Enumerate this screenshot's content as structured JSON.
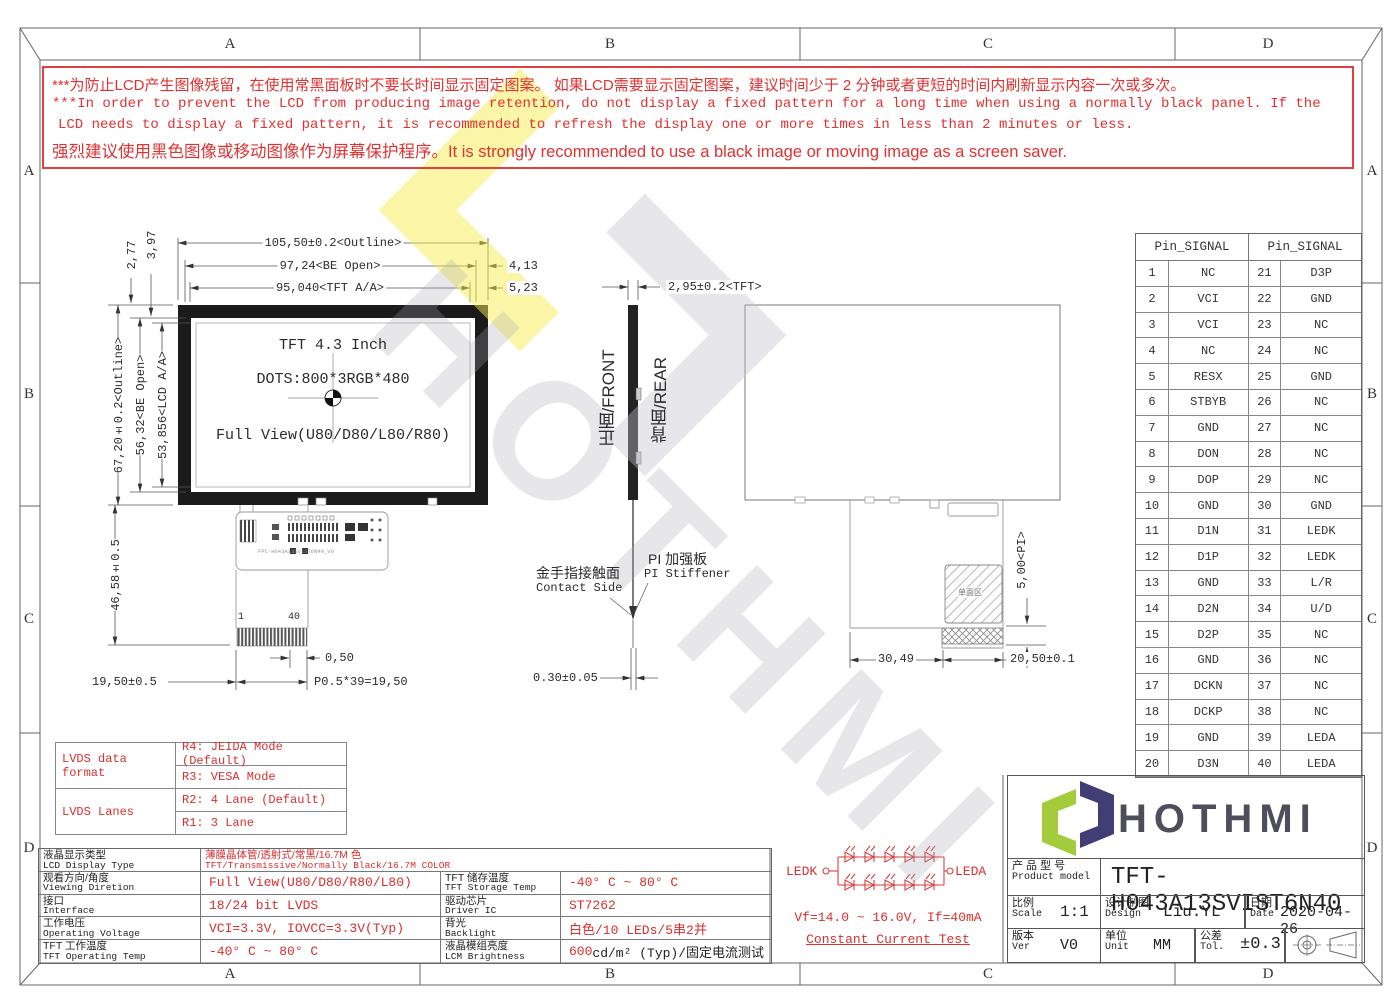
{
  "frame": {
    "zones": [
      "A",
      "B",
      "C",
      "D"
    ]
  },
  "warning": {
    "line1_cn": "***为防止LCD产生图像残留，在使用常黑面板时不要长时间显示固定图案。 如果LCD需要显示固定图案，建议时间少于 2 分钟或者更短的时间内刷新显示内容一次或多次。",
    "line2_en": "***In order to prevent the LCD from producing image retention, do not display a fixed pattern for a long time when using a normally black panel. If the",
    "line3_en": "LCD needs to display a fixed pattern, it is recommended to refresh the display one or more times in less than 2 minutes or less.",
    "line4_mixed": "强烈建议使用黑色图像或移动图像作为屏幕保护程序。It is strongly recommended to use a black image or moving image as a screen saver."
  },
  "watermark": {
    "text": "HOTHMI"
  },
  "front_view": {
    "title": "TFT 4.3 Inch",
    "dots": "DOTS:800*3RGB*480",
    "view": "Full View(U80/D80/L80/R80)",
    "fpc_label": "FPC-H043A13SVIST6N40_V0",
    "pin_start": "1",
    "pin_end": "40"
  },
  "side_view": {
    "front_label": "正面/FRONT",
    "rear_label": "背面/REAR",
    "contact_cn": "金手指接触面",
    "contact_en": "Contact Side",
    "stiffener_cn": "PI 加强板",
    "stiffener_en": "PI Stiffener"
  },
  "rear_view": {
    "hatch_label": "单面区"
  },
  "dims": {
    "outline_w": "105,50±0.2<Outline>",
    "be_open_w": "97,24<BE Open>",
    "tft_aa_w": "95,040<TFT A/A>",
    "gap_right_1": "4,13",
    "gap_right_2": "5,23",
    "gap_top_1": "2,77",
    "gap_top_2": "3,97",
    "outline_h": "67,20±0.2<Outline>",
    "be_open_h": "56,32<BE Open>",
    "lcd_aa_h": "53,856<LCD A/A>",
    "fpc_len": "46,58±0.5",
    "tail_w": "19,50±0.5",
    "pitch_one": "0,50",
    "pitch_total": "P0.5*39=19,50",
    "thickness": "2,95±0.2<TFT>",
    "fpc_thick": "0.30±0.05",
    "pi_len": "5,00<PI>",
    "tail_x": "30,49",
    "tail_w2": "20,50±0.1"
  },
  "pin_table": {
    "header1": "Pin_SIGNAL",
    "header2": "Pin_SIGNAL",
    "rows": [
      {
        "p1": "1",
        "s1": "NC",
        "p2": "21",
        "s2": "D3P"
      },
      {
        "p1": "2",
        "s1": "VCI",
        "p2": "22",
        "s2": "GND"
      },
      {
        "p1": "3",
        "s1": "VCI",
        "p2": "23",
        "s2": "NC"
      },
      {
        "p1": "4",
        "s1": "NC",
        "p2": "24",
        "s2": "NC"
      },
      {
        "p1": "5",
        "s1": "RESX",
        "p2": "25",
        "s2": "GND"
      },
      {
        "p1": "6",
        "s1": "STBYB",
        "p2": "26",
        "s2": "NC"
      },
      {
        "p1": "7",
        "s1": "GND",
        "p2": "27",
        "s2": "NC"
      },
      {
        "p1": "8",
        "s1": "DON",
        "p2": "28",
        "s2": "NC"
      },
      {
        "p1": "9",
        "s1": "DOP",
        "p2": "29",
        "s2": "NC"
      },
      {
        "p1": "10",
        "s1": "GND",
        "p2": "30",
        "s2": "GND"
      },
      {
        "p1": "11",
        "s1": "D1N",
        "p2": "31",
        "s2": "LEDK"
      },
      {
        "p1": "12",
        "s1": "D1P",
        "p2": "32",
        "s2": "LEDK"
      },
      {
        "p1": "13",
        "s1": "GND",
        "p2": "33",
        "s2": "L/R"
      },
      {
        "p1": "14",
        "s1": "D2N",
        "p2": "34",
        "s2": "U/D"
      },
      {
        "p1": "15",
        "s1": "D2P",
        "p2": "35",
        "s2": "NC"
      },
      {
        "p1": "16",
        "s1": "GND",
        "p2": "36",
        "s2": "NC"
      },
      {
        "p1": "17",
        "s1": "DCKN",
        "p2": "37",
        "s2": "NC"
      },
      {
        "p1": "18",
        "s1": "DCKP",
        "p2": "38",
        "s2": "NC"
      },
      {
        "p1": "19",
        "s1": "GND",
        "p2": "39",
        "s2": "LEDA"
      },
      {
        "p1": "20",
        "s1": "D3N",
        "p2": "40",
        "s2": "LEDA"
      }
    ]
  },
  "lvds_table": {
    "group1": "LVDS data format",
    "g1r1": "R4: JEIDA Mode (Default)",
    "g1r2": "R3: VESA Mode",
    "group2": "LVDS Lanes",
    "g2r1": "R2: 4 Lane (Default)",
    "g2r2": "R1: 3 Lane"
  },
  "spec_table": {
    "r1_label_cn": "液晶显示类型",
    "r1_label_en": "LCD Display Type",
    "r1_val_cn": "薄膜晶体管/透射式/常黑/16.7M 色",
    "r1_val_en": "TFT/Transmissive/Normally Black/16.7M COLOR",
    "r2a_cn": "观看方向/角度",
    "r2a_en": "Viewing Diretion",
    "r2a_val": "Full View(U80/D80/R80/L80)",
    "r2b_cn": "TFT 储存温度",
    "r2b_en": "TFT Storage Temp",
    "r2b_val": "-40° C ~ 80° C",
    "r3a_cn": "接口",
    "r3a_en": "Interface",
    "r3a_val": "18/24 bit LVDS",
    "r3b_cn": "驱动芯片",
    "r3b_en": "Driver IC",
    "r3b_val": "ST7262",
    "r4a_cn": "工作电压",
    "r4a_en": "Operating Voltage",
    "r4a_val": "VCI=3.3V, IOVCC=3.3V(Typ)",
    "r4b_cn": "背光",
    "r4b_en": "Backlight",
    "r4b_val": "白色/10 LEDs/5串2并",
    "r5a_cn": "TFT 工作温度",
    "r5a_en": "TFT Operating Temp",
    "r5a_val": "-40° C ~ 80° C",
    "r5b_cn": "液晶模组亮度",
    "r5b_en": "LCM Brightness",
    "r5b_val_red": "600",
    "r5b_val_rest": " cd/m² (Typ)/固定电流测试"
  },
  "led_circuit": {
    "ledk": "LEDK",
    "leda": "LEDA",
    "spec": "Vf=14.0 ~ 16.0V, If=40mA",
    "test": "Constant Current Test"
  },
  "title_block": {
    "brand": "HOTHMI",
    "model_label_cn": "产 品 型 号",
    "model_label_en": "Product model",
    "model": "TFT-H043A13SVIST6N40",
    "scale_cn": "比例",
    "scale_en": "Scale",
    "scale": "1:1",
    "design_cn": "设计制图",
    "design_en": "Design",
    "designer": "Liu.YL",
    "date_cn": "日期",
    "date_en": "Date",
    "date": "2020-04-26",
    "ver_cn": "版本",
    "ver_en": "Ver",
    "ver": "V0",
    "unit_cn": "单位",
    "unit_en": "Unit",
    "unit": "MM",
    "tol_cn": "公差",
    "tol_en": "Tol.",
    "tol": "±0.3"
  }
}
